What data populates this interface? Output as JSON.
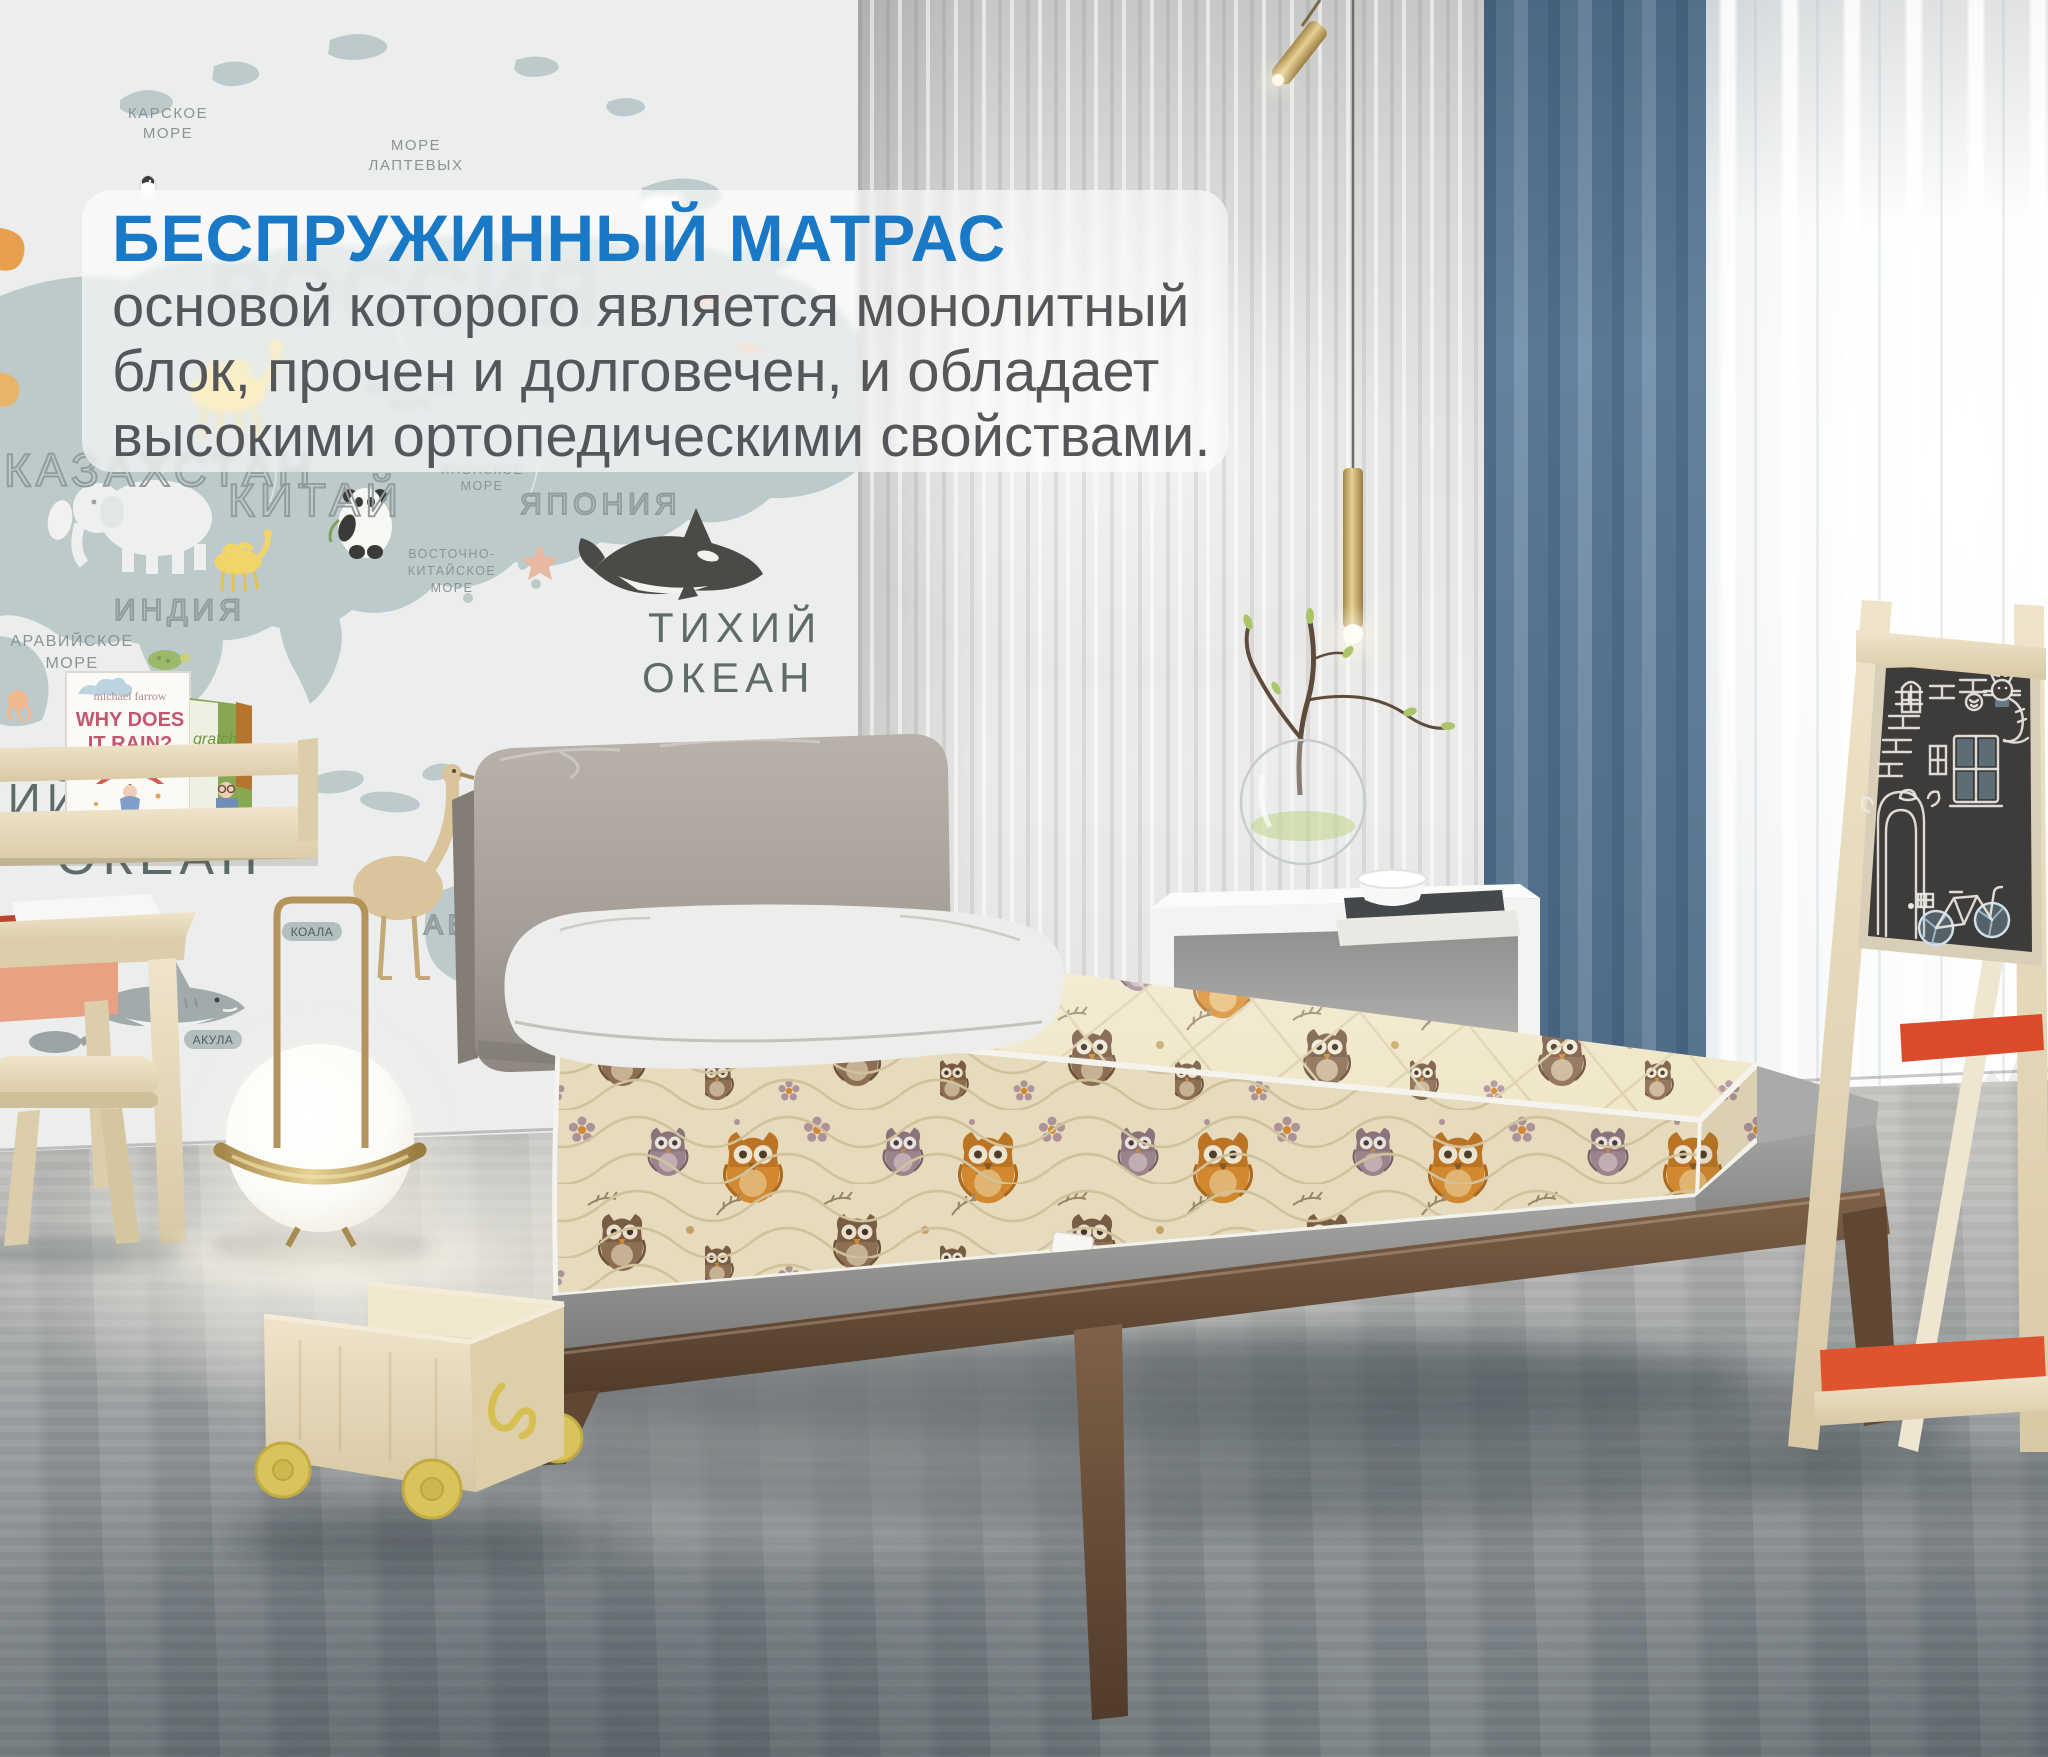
{
  "overlay": {
    "title": "БЕСПРУЖИННЫЙ МАТРАС",
    "line1": "основой которого является монолитный",
    "line2": "блок, прочен и долговечен, и обладает",
    "line3": "высокими ортопедическими свойствами.",
    "title_color": "#1a79c6",
    "text_color": "#55565a",
    "panel_background": "rgba(255,255,255,0.62)"
  },
  "wall_map": {
    "country_labels": {
      "russia": "РОССИЯ",
      "kazakhstan": "КАЗАХСТАН",
      "china": "КИТАЙ",
      "japan": "ЯПОНИЯ",
      "india": "ИНДИЯ",
      "australia": "АВСТРАЛИЯ"
    },
    "sea_labels": {
      "kara_1": "КАРСКОЕ",
      "kara_2": "МОРЕ",
      "laptev_1": "МОРЕ",
      "laptev_2": "ЛАПТЕВЫХ",
      "bering_1": "БЕРИНГОВО",
      "bering_2": "МОРЕ",
      "japan_sea_1": "ЯПОНСКОЕ",
      "japan_sea_2": "МОРЕ",
      "east_china_1": "ВОСТОЧНО-",
      "east_china_2": "КИТАЙСКОЕ",
      "east_china_3": "МОРЕ",
      "arabian_1": "АРАВИЙСКОЕ",
      "arabian_2": "МОРЕ",
      "pacific_1": "ТИХИЙ",
      "pacific_2": "ОКЕАН",
      "indian_1": "ИНДИЙСКИЙ",
      "indian_2": "ОКЕАН"
    },
    "animal_tags": {
      "shark": "АКУЛА",
      "koala": "КОАЛА"
    }
  },
  "bookshelf": {
    "book_rain": {
      "author": "michael farrow",
      "title_1": "WHY DOES",
      "title_2": "IT RAIN?"
    },
    "book_green": {
      "title": "gratch",
      "subtitle": "butterfly"
    }
  },
  "palette": {
    "accent_blue_title": "#1a79c6",
    "curtain_blue": "#63829f",
    "mattress_cream": "#f0e6c7",
    "owl_orange": "#d98c2f",
    "wood_walnut": "#6e523c",
    "wood_birch": "#e9ddc2",
    "wheel_yellow": "#d9c45c",
    "easel_tray_red": "#dc4a2c",
    "brass": "#c9ad6b"
  }
}
